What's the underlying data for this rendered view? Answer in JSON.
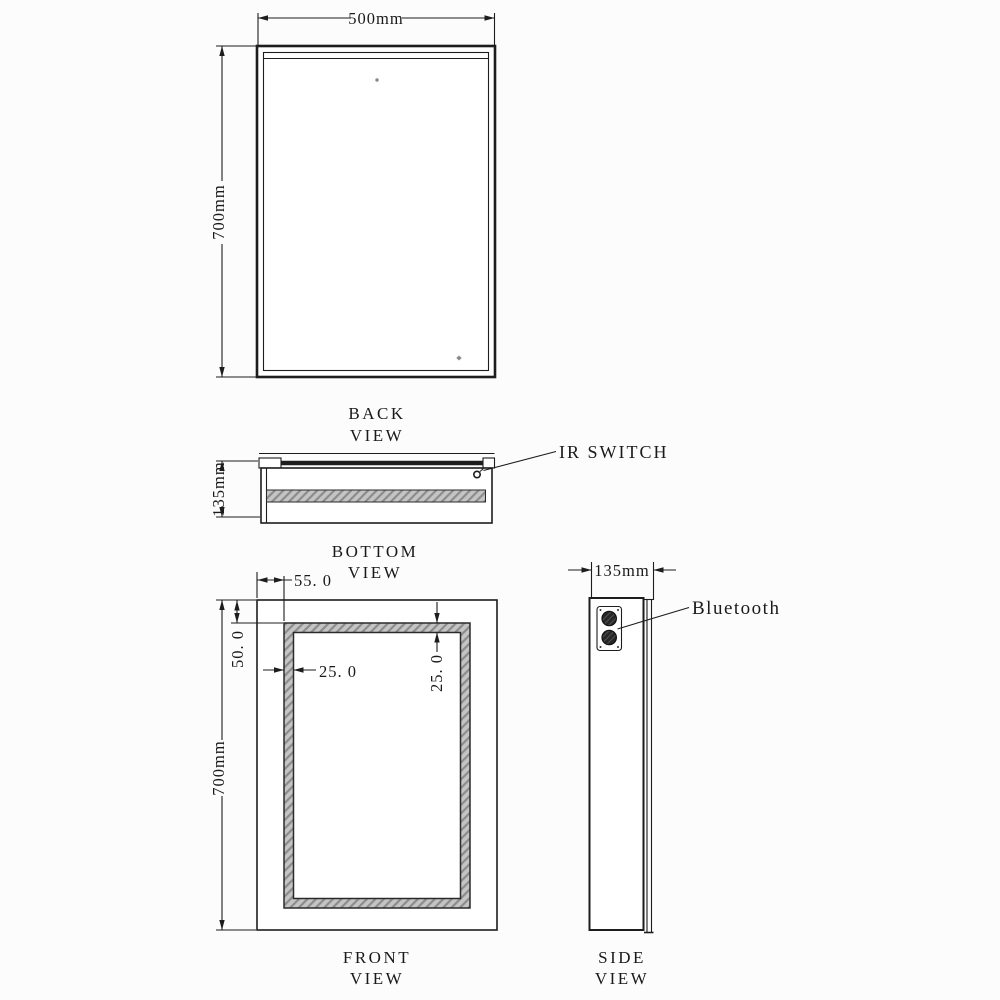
{
  "colors": {
    "line": "#1d1d1d",
    "hatch_base": "#c4c4c4",
    "hatch_stripe": "#8c8c8c",
    "speaker_fill": "#262626",
    "background": "#fcfcfc"
  },
  "views": {
    "back": {
      "label": [
        "BACK",
        "VIEW"
      ],
      "dim_width": "500mm",
      "dim_height": "700mm"
    },
    "bottom": {
      "label": [
        "BOTTOM",
        "VIEW"
      ],
      "dim_depth": "135mm",
      "callout_ir": "IR SWITCH"
    },
    "front": {
      "label": [
        "FRONT",
        "VIEW"
      ],
      "dim_height": "700mm",
      "dim_offset_left": "55. 0",
      "dim_offset_top": "50. 0",
      "dim_band_left": "25. 0",
      "dim_band_top": "25. 0"
    },
    "side": {
      "label": [
        "SIDE",
        "VIEW"
      ],
      "dim_depth": "135mm",
      "callout_bluetooth": "Bluetooth"
    }
  }
}
